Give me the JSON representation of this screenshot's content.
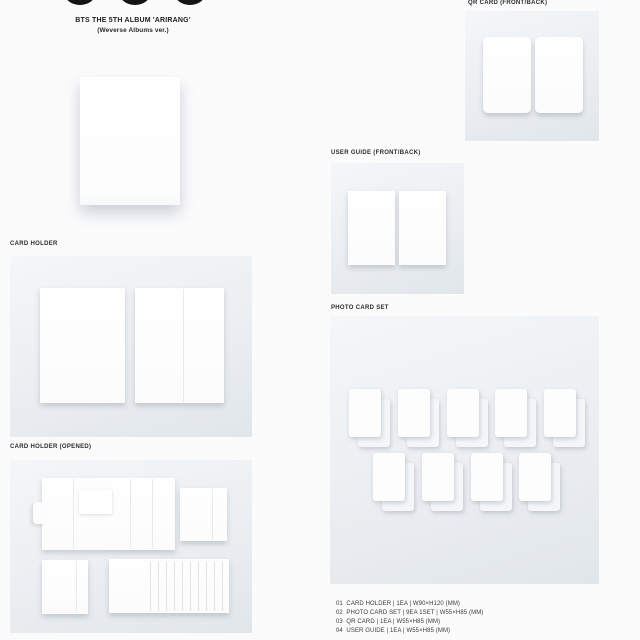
{
  "header": {
    "logo_dot_count": 3,
    "title_line1": "BTS THE 5TH ALBUM 'ARIRANG'",
    "title_line2": "(Weverse Albums ver.)"
  },
  "sections": {
    "card_holder": {
      "label": "CARD HOLDER"
    },
    "card_holder_opened": {
      "label": "CARD HOLDER (OPENED)"
    },
    "qr_card": {
      "label": "QR CARD (FRONT/BACK)"
    },
    "user_guide": {
      "label": "USER GUIDE (FRONT/BACK)"
    },
    "photo_card_set": {
      "label": "PHOTO CARD SET",
      "rows": [
        {
          "count": 5
        },
        {
          "count": 4
        }
      ]
    }
  },
  "spec_list": [
    "01  CARD HOLDER | 1EA | W90×H120 (MM)",
    "02  PHOTO CARD SET | 9EA 1SET | W55×H85 (MM)",
    "03  QR CARD | 1EA | W55×H85 (MM)",
    "04  USER GUIDE | 1EA | W55×H85 (MM)"
  ],
  "colors": {
    "page_bg": "#fbfbfc",
    "panel_top": "#f4f6f8",
    "panel_bottom": "#e1e6ea",
    "card_white": "#fdfdfe",
    "dot_black": "#141414"
  }
}
